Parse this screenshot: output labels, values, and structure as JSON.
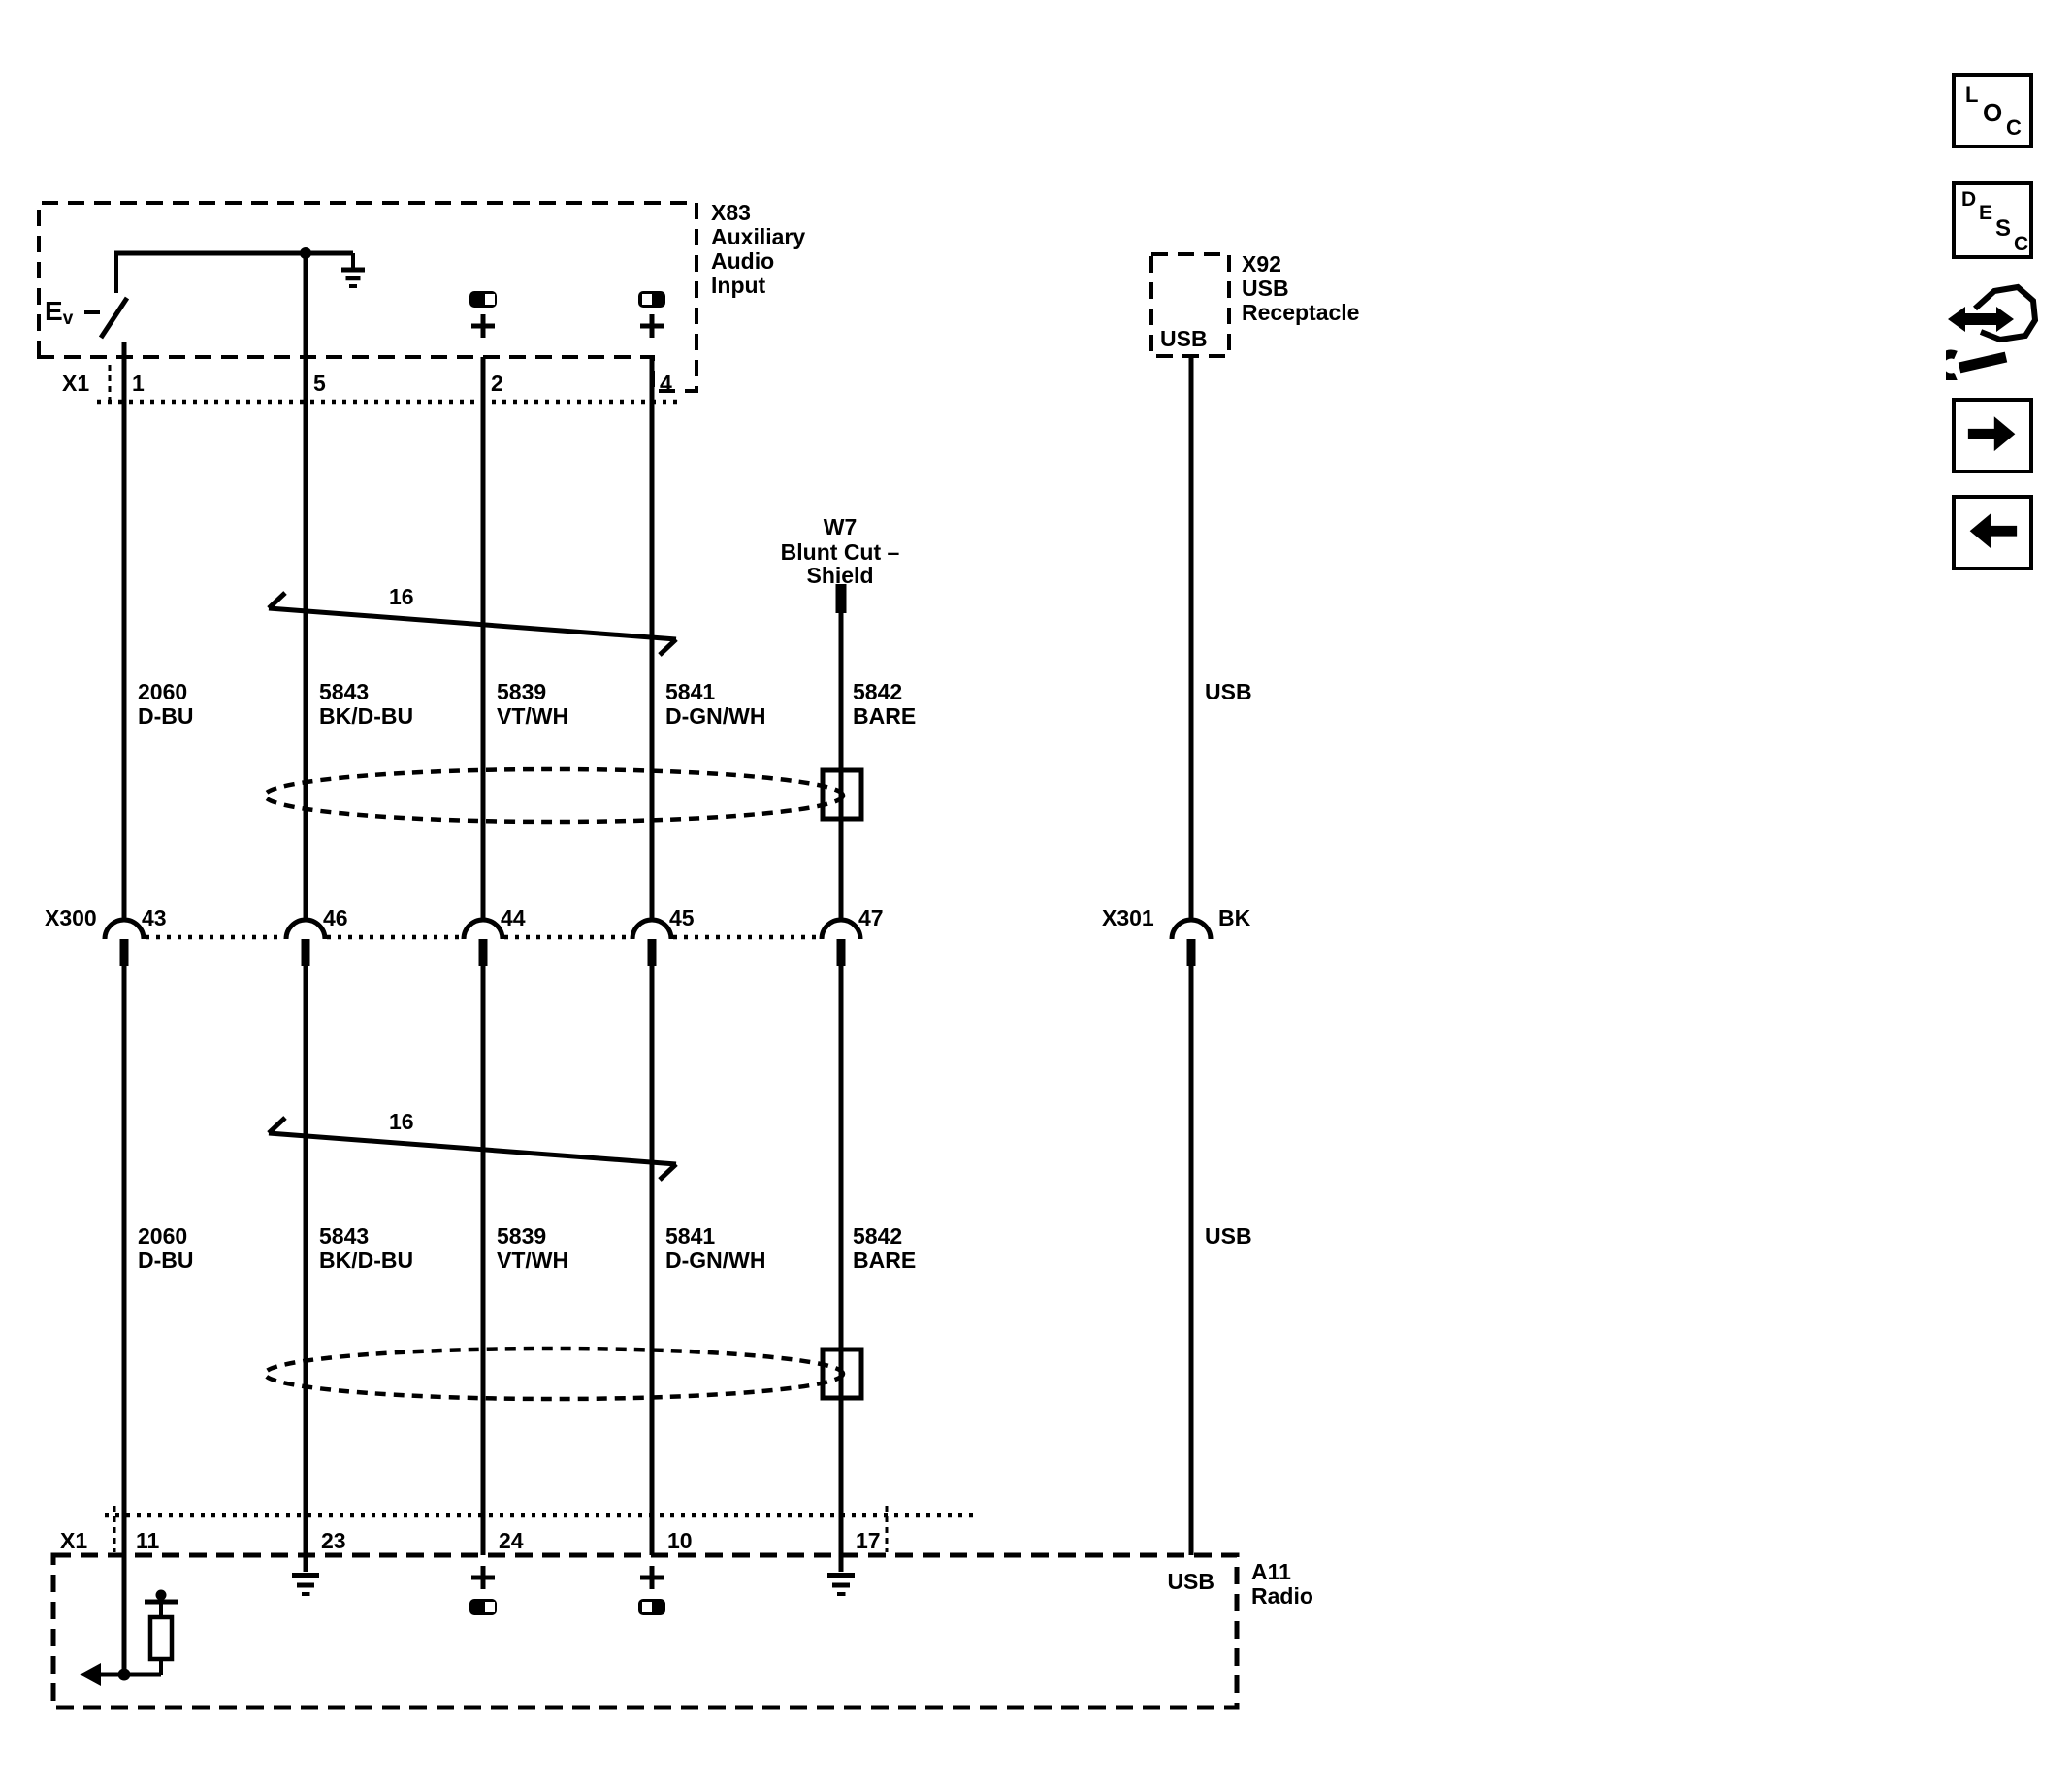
{
  "diagram": {
    "components": {
      "x83": {
        "id": "X83",
        "name_lines": [
          "Auxiliary",
          "Audio",
          "Input"
        ],
        "switch_label": "E",
        "switch_label_sub": "v"
      },
      "x92": {
        "id": "X92",
        "name_lines": [
          "USB",
          "Receptacle"
        ],
        "pin_label": "USB"
      },
      "w7": {
        "id": "W7",
        "name_line1": "Blunt Cut –",
        "name_line2": "Shield"
      },
      "a11": {
        "id": "A11",
        "name": "Radio",
        "usb_pin_label": "USB"
      }
    },
    "connectors": {
      "x1_top": {
        "id": "X1",
        "pins": [
          "1",
          "5",
          "2",
          "4"
        ]
      },
      "x300": {
        "id": "X300",
        "pins": [
          "43",
          "46",
          "44",
          "45",
          "47"
        ]
      },
      "x301": {
        "id": "X301",
        "wire_color": "BK"
      },
      "x1_bottom": {
        "id": "X1",
        "pins": [
          "11",
          "23",
          "24",
          "10",
          "17"
        ]
      }
    },
    "wires": [
      {
        "circuit": "2060",
        "color": "D-BU"
      },
      {
        "circuit": "5843",
        "color": "BK/D-BU"
      },
      {
        "circuit": "5839",
        "color": "VT/WH"
      },
      {
        "circuit": "5841",
        "color": "D-GN/WH"
      },
      {
        "circuit": "5842",
        "color": "BARE"
      }
    ],
    "usb_wire_label": "USB",
    "twisted_pair_label": "16",
    "colors": {
      "ink": "#000000",
      "paper": "#ffffff"
    }
  },
  "toolbar": {
    "loc_letters": [
      "L",
      "O",
      "C"
    ],
    "desc_letters": [
      "D",
      "E",
      "S",
      "C"
    ]
  }
}
